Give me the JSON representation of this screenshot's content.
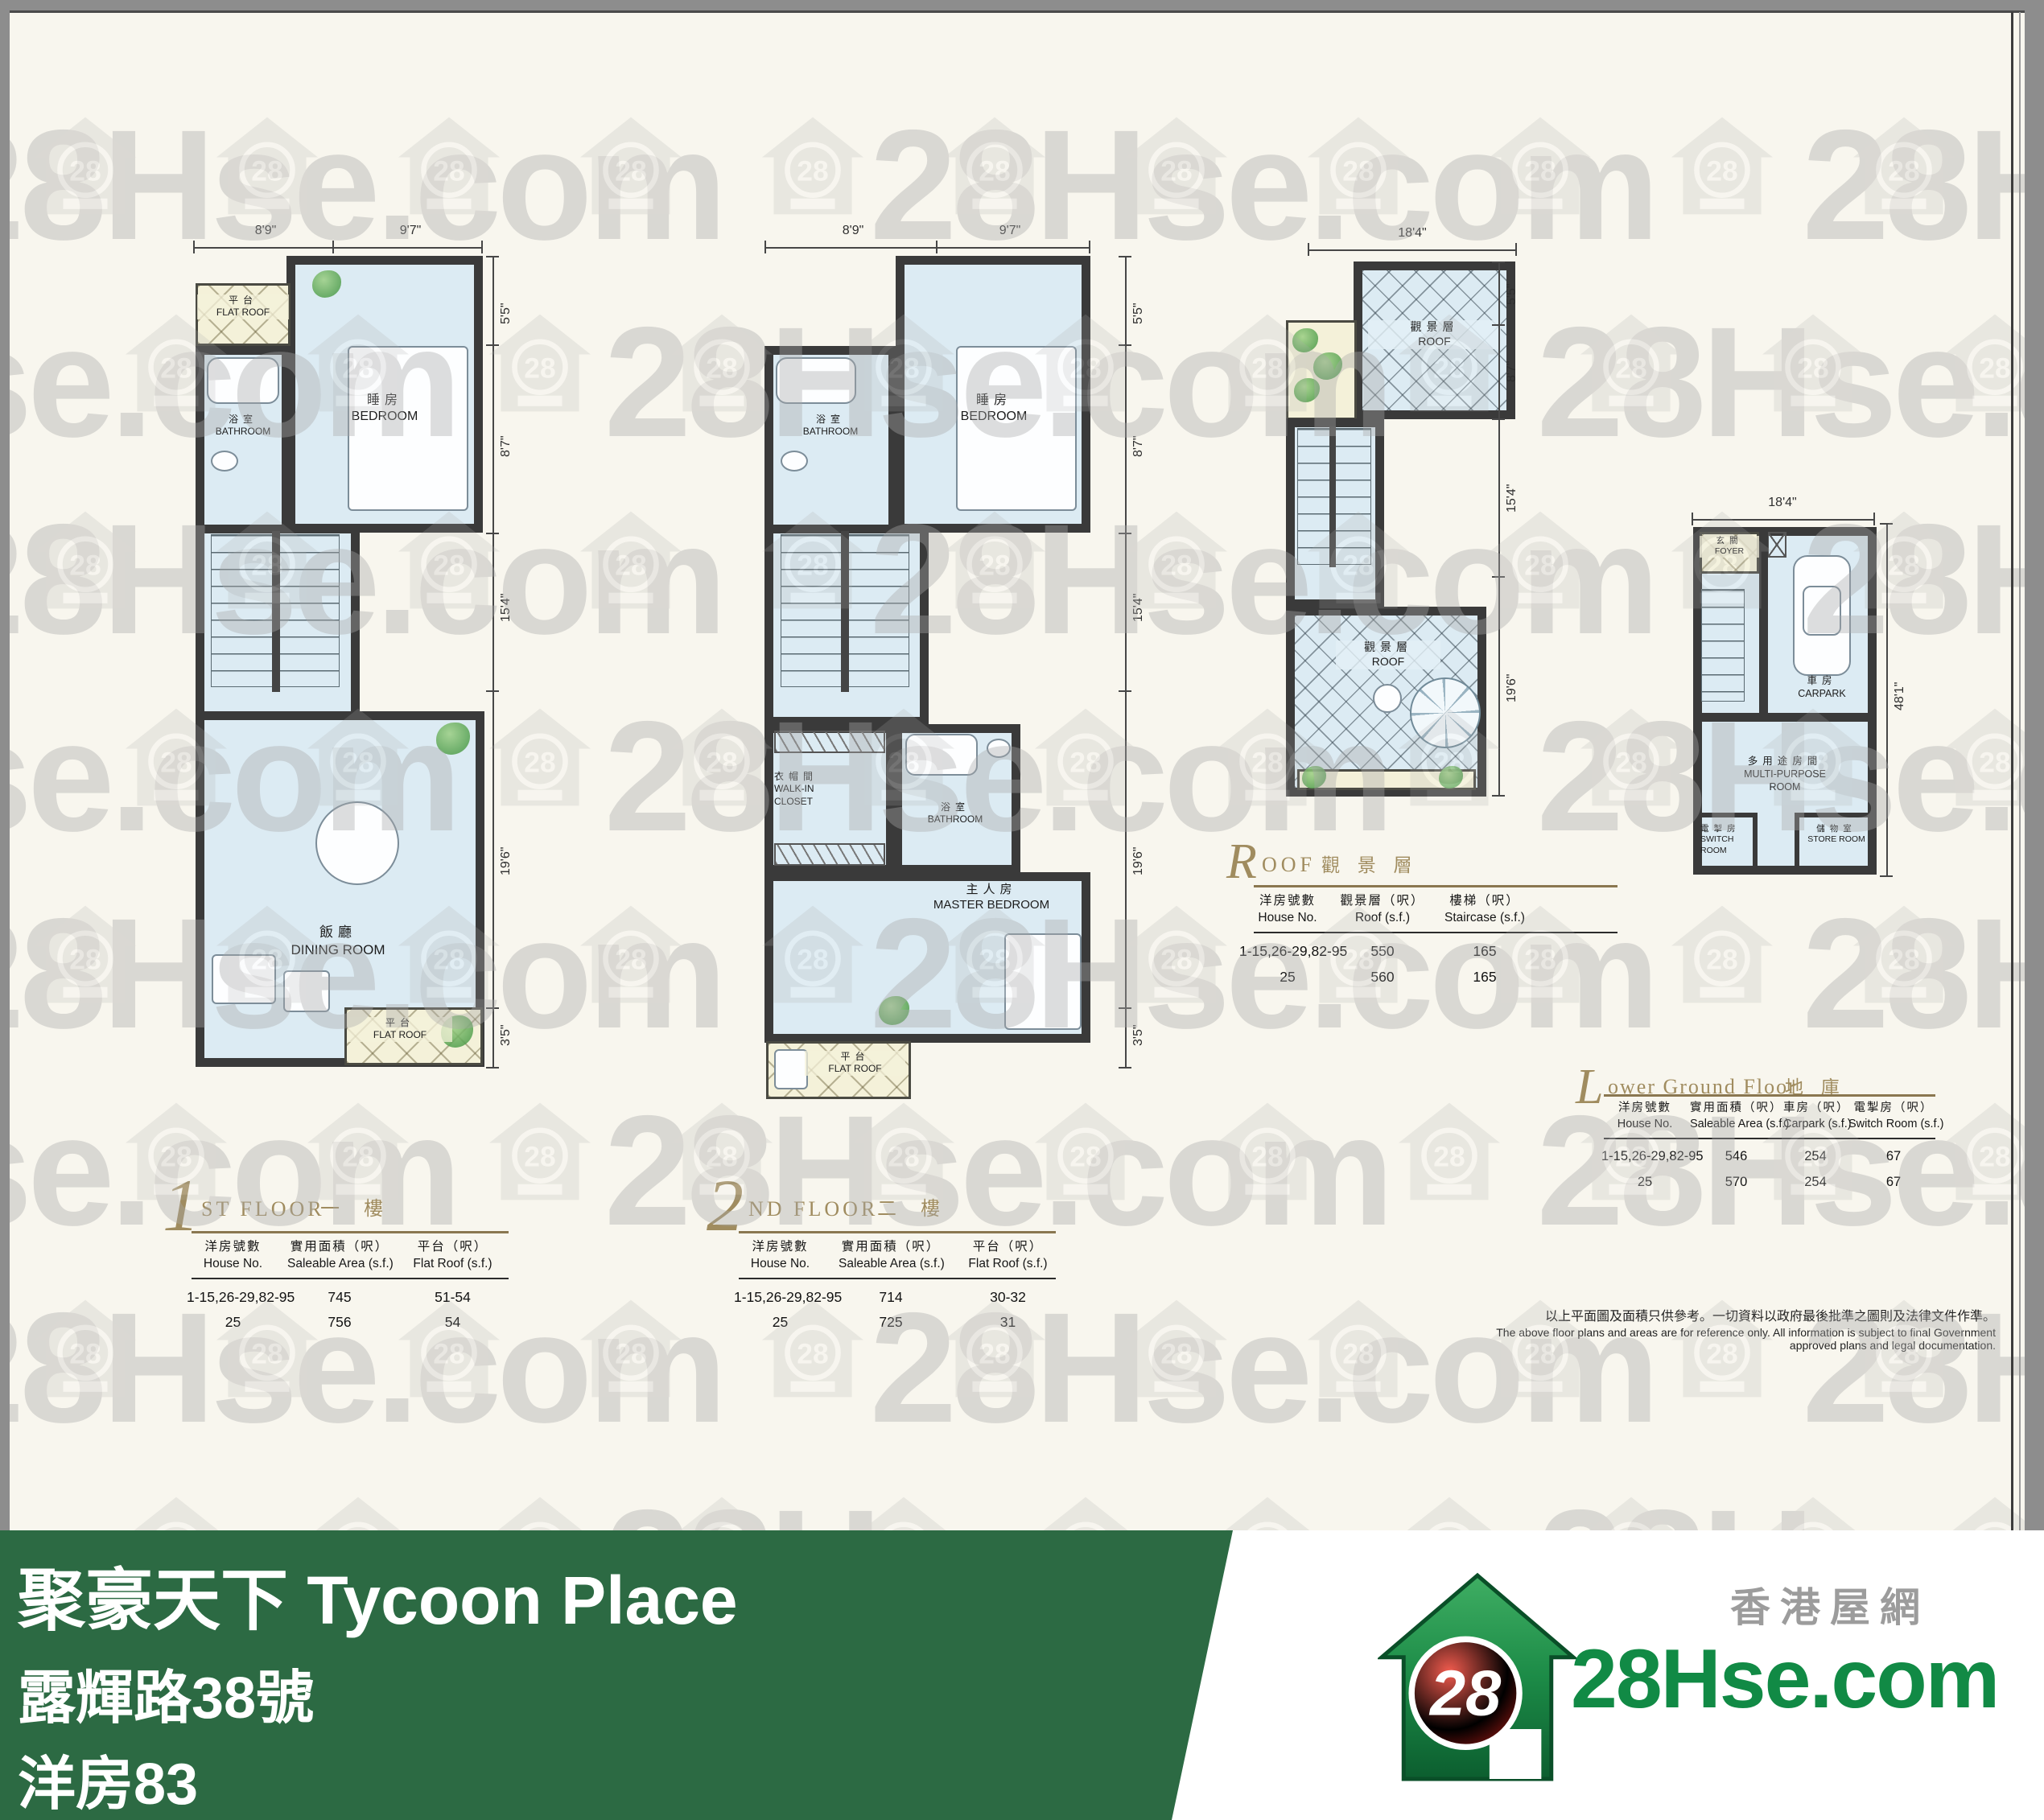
{
  "watermark": {
    "text": "28Hse.com",
    "badge": "28"
  },
  "plans": [
    {
      "name": "1st Floor",
      "num": "1",
      "title": "ST FLOOR",
      "title_zh": "一 樓",
      "dims_top": [
        "8'9\"",
        "9'7\""
      ],
      "dims_side": [
        "5'5\"",
        "8'7\"",
        "15'4\"",
        "19'6\"",
        "3'5\""
      ],
      "rooms": {
        "flat_roof_top": {
          "zh": "平台",
          "en": "FLAT ROOF"
        },
        "bathroom": {
          "zh": "浴室",
          "en": "BATHROOM"
        },
        "bedroom": {
          "zh": "睡房",
          "en": "BEDROOM"
        },
        "dining": {
          "zh": "飯廳",
          "en": "DINING ROOM"
        },
        "flat_roof_bottom": {
          "zh": "平台",
          "en": "FLAT ROOF"
        }
      },
      "table": {
        "headers": [
          [
            "洋房號數",
            "House No."
          ],
          [
            "實用面積（呎）",
            "Saleable Area (s.f.)"
          ],
          [
            "平台（呎）",
            "Flat Roof (s.f.)"
          ]
        ],
        "rows": [
          [
            "1-15,26-29,82-95",
            "745",
            "51-54"
          ],
          [
            "25",
            "756",
            "54"
          ]
        ]
      }
    },
    {
      "name": "2nd Floor",
      "num": "2",
      "title": "ND FLOOR",
      "title_zh": "二 樓",
      "dims_top": [
        "8'9\"",
        "9'7\""
      ],
      "dims_side": [
        "5'5\"",
        "8'7\"",
        "15'4\"",
        "19'6\"",
        "3'5\""
      ],
      "rooms": {
        "bathroom": {
          "zh": "浴室",
          "en": "BATHROOM"
        },
        "bedroom": {
          "zh": "睡房",
          "en": "BEDROOM"
        },
        "walk_in": {
          "zh": "衣帽間",
          "en": "WALK-IN CLOSET"
        },
        "bathroom2": {
          "zh": "浴室",
          "en": "BATHROOM"
        },
        "master": {
          "zh": "主人房",
          "en": "MASTER BEDROOM"
        },
        "flat_roof_bottom": {
          "zh": "平台",
          "en": "FLAT ROOF"
        }
      },
      "table": {
        "headers": [
          [
            "洋房號數",
            "House No."
          ],
          [
            "實用面積（呎）",
            "Saleable Area (s.f.)"
          ],
          [
            "平台（呎）",
            "Flat Roof (s.f.)"
          ]
        ],
        "rows": [
          [
            "1-15,26-29,82-95",
            "714",
            "30-32"
          ],
          [
            "25",
            "725",
            "31"
          ]
        ]
      }
    },
    {
      "name": "Roof",
      "num": "R",
      "title": "OOF",
      "title_zh": "觀 景 層",
      "dims_top": [
        "18'4\""
      ],
      "dims_side": [
        "5'5\"",
        "8'7\"",
        "15'4\"",
        "19'6\""
      ],
      "rooms": {
        "roof_upper": {
          "zh": "觀景層",
          "en": "ROOF"
        },
        "roof_lower": {
          "zh": "觀景層",
          "en": "ROOF"
        }
      },
      "table": {
        "headers": [
          [
            "洋房號數",
            "House No."
          ],
          [
            "觀景層（呎）",
            "Roof (s.f.)"
          ],
          [
            "樓梯（呎）",
            "Staircase (s.f.)"
          ]
        ],
        "rows": [
          [
            "1-15,26-29,82-95",
            "550",
            "165"
          ],
          [
            "25",
            "560",
            "165"
          ]
        ]
      }
    },
    {
      "name": "Lower Ground Floor",
      "num": "L",
      "title": "ower Ground Floor",
      "title_zh": "地 庫",
      "dims_top": [
        "18'4\""
      ],
      "dims_side": [
        "48'1\""
      ],
      "rooms": {
        "foyer": {
          "zh": "玄關",
          "en": "FOYER"
        },
        "carpark": {
          "zh": "車房",
          "en": "CARPARK"
        },
        "multi": {
          "zh": "多用途房間",
          "en": "MULTI-PURPOSE ROOM"
        },
        "switch": {
          "zh": "電掣房",
          "en": "SWITCH ROOM"
        },
        "store": {
          "zh": "儲物室",
          "en": "STORE ROOM"
        }
      },
      "table": {
        "headers": [
          [
            "洋房號數",
            "House No."
          ],
          [
            "實用面積（呎）",
            "Saleable Area (s.f.)"
          ],
          [
            "車房（呎）",
            "Carpark (s.f.)"
          ],
          [
            "電掣房（呎）",
            "Switch Room (s.f.)"
          ]
        ],
        "rows": [
          [
            "1-15,26-29,82-95",
            "546",
            "254",
            "67"
          ],
          [
            "25",
            "570",
            "254",
            "67"
          ]
        ]
      }
    }
  ],
  "disclaimer": {
    "zh": "以上平面圖及面積只供參考。一切資料以政府最後批準之圖則及法律文件作準。",
    "en": "The above floor plans and areas are for reference only. All information is subject to final Government approved plans and legal documentation."
  },
  "banner": {
    "title": "聚豪天下 Tycoon Place",
    "address": "露輝路38號",
    "house": "洋房83",
    "bg": "#2c6a43"
  },
  "logo": {
    "badge": "28",
    "brand": "28Hse.com",
    "tagline": "香港屋網"
  }
}
